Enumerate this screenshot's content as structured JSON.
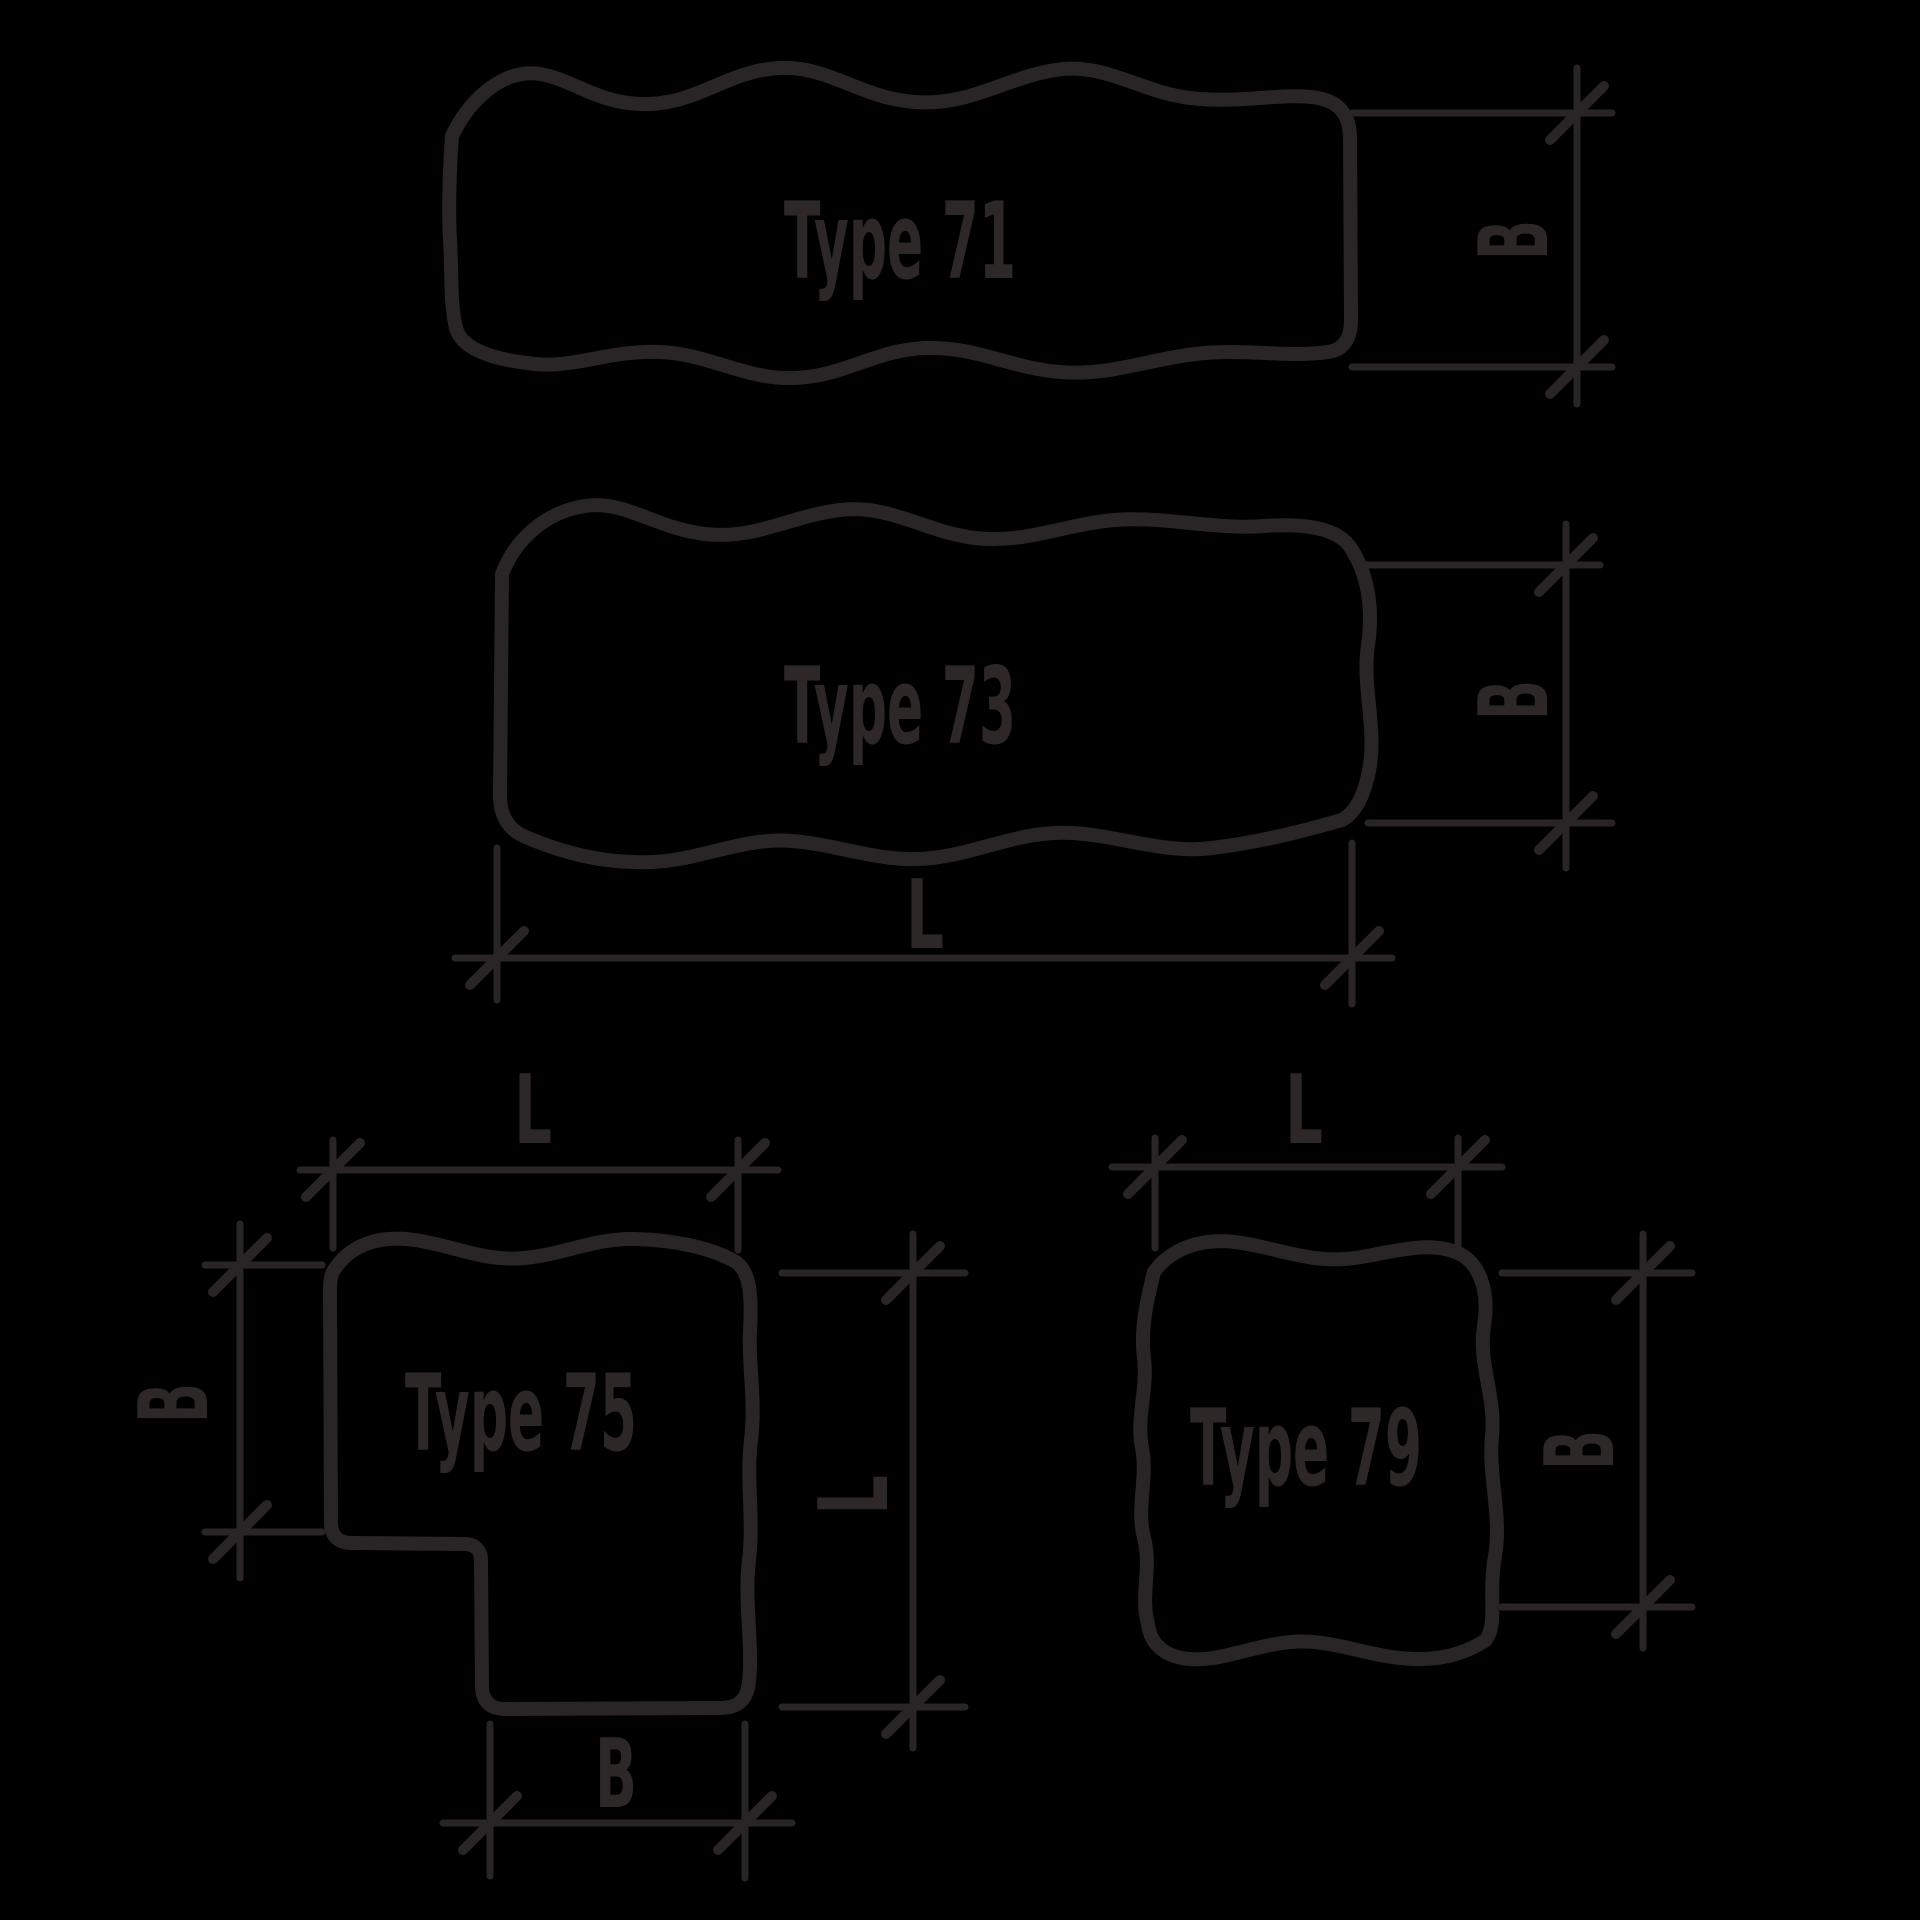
{
  "colors": {
    "background": "#000000",
    "line": "#292425",
    "text": "#2d2728"
  },
  "diagram": {
    "description": "Profile type dimension sketches",
    "figures": [
      {
        "label": "Type 71",
        "dimensions": [
          "B"
        ]
      },
      {
        "label": "Type 73",
        "dimensions": [
          "B",
          "L"
        ]
      },
      {
        "label": "Type 75",
        "dimensions": [
          "L",
          "B",
          "L",
          "B"
        ]
      },
      {
        "label": "Type 79",
        "dimensions": [
          "L",
          "B"
        ]
      }
    ]
  }
}
